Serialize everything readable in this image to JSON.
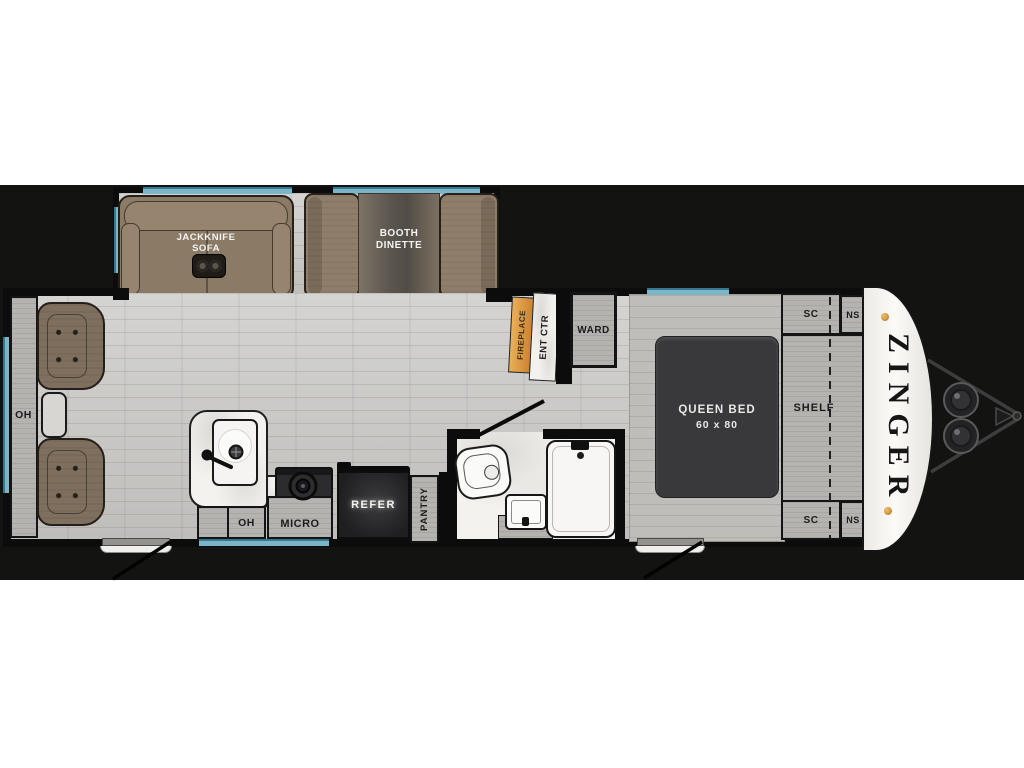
{
  "floorplan": {
    "brand": "ZINGER",
    "labels": {
      "sofa": "JACKKNIFE\nSOFA",
      "dinette": "BOOTH\nDINETTE",
      "rear_overhead": "OH",
      "kitchen_overhead": "OH",
      "microwave": "MICRO",
      "refrigerator": "REFER",
      "pantry": "PANTRY",
      "fireplace": "FIREPLACE",
      "entertainment_center": "ENT CTR",
      "wardrobe": "WARD",
      "bed_name": "QUEEN BED",
      "bed_size": "60 x 80",
      "shelf": "SHELF",
      "sc_top": "SC",
      "ns_top": "NS",
      "sc_bottom": "SC",
      "ns_bottom": "NS"
    },
    "colors": {
      "window_blue": "#7db5c8",
      "fireplace_orange": "#dd9440",
      "bed_charcoal": "#39393b",
      "marker_amber": "#d99b2e",
      "backdrop_black": "#131312",
      "floor_gray": "#c9c8c5"
    }
  }
}
